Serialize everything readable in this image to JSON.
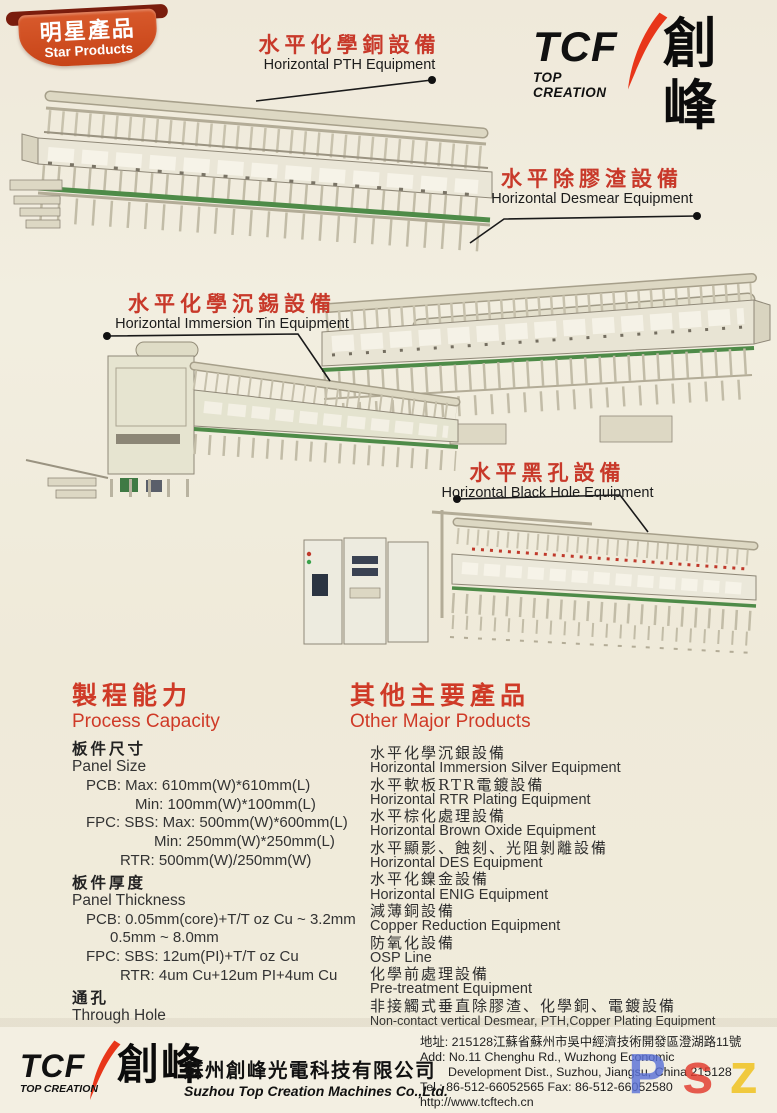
{
  "badge": {
    "title_zh": "明星產品",
    "title_en": "Star Products"
  },
  "logo": {
    "tcf": "TCF",
    "zh": "創峰",
    "sub": "TOP CREATION"
  },
  "callouts": [
    {
      "zh": "水平化學銅設備",
      "en": "Horizontal PTH Equipment"
    },
    {
      "zh": "水平除膠渣設備",
      "en": "Horizontal Desmear Equipment"
    },
    {
      "zh": "水平化學沉錫設備",
      "en": "Horizontal Immersion Tin Equipment"
    },
    {
      "zh": "水平黑孔設備",
      "en": "Horizontal Black Hole Equipment"
    }
  ],
  "process_capacity": {
    "title_zh": "製程能力",
    "title_en": "Process Capacity",
    "sections": [
      {
        "zh": "板件尺寸",
        "en": "Panel Size",
        "lines": [
          {
            "text": "PCB: Max: 610mm(W)*610mm(L)",
            "indent": 1
          },
          {
            "text": "Min: 100mm(W)*100mm(L)",
            "indent": 4
          },
          {
            "text": "FPC: SBS: Max: 500mm(W)*600mm(L)",
            "indent": 1
          },
          {
            "text": "Min: 250mm(W)*250mm(L)",
            "indent": 5
          },
          {
            "text": "RTR: 500mm(W)/250mm(W)",
            "indent": 3
          }
        ]
      },
      {
        "zh": "板件厚度",
        "en": "Panel Thickness",
        "lines": [
          {
            "text": "PCB: 0.05mm(core)+T/T oz Cu ~ 3.2mm",
            "indent": 1
          },
          {
            "text": "0.5mm ~ 8.0mm",
            "indent": 2
          },
          {
            "text": "FPC: SBS: 12um(PI)+T/T oz Cu",
            "indent": 1
          },
          {
            "text": "RTR: 4um Cu+12um PI+4um Cu",
            "indent": 3
          }
        ]
      },
      {
        "zh": "通孔",
        "en": "Through Hole",
        "lines": [
          {
            "text": "A/R 12:1",
            "indent": 1
          }
        ]
      },
      {
        "zh": "盲孔",
        "en": "Blind Hole",
        "lines": [
          {
            "text": "A/R 1:1",
            "indent": 1
          }
        ]
      }
    ]
  },
  "other_products": {
    "title_zh": "其他主要產品",
    "title_en": "Other Major Products",
    "items": [
      {
        "zh": "水平化學沉銀設備",
        "en": "Horizontal Immersion Silver Equipment"
      },
      {
        "zh": "水平軟板RTR電鍍設備",
        "en": "Horizontal RTR Plating Equipment"
      },
      {
        "zh": "水平棕化處理設備",
        "en": "Horizontal Brown Oxide Equipment"
      },
      {
        "zh": "水平顯影、蝕刻、光阻剝離設備",
        "en": "Horizontal DES Equipment"
      },
      {
        "zh": "水平化鎳金設備",
        "en": "Horizontal ENIG Equipment"
      },
      {
        "zh": "減薄銅設備",
        "en": "Copper Reduction Equipment"
      },
      {
        "zh": "防氧化設備",
        "en": "OSP Line"
      },
      {
        "zh": "化學前處理設備",
        "en": "Pre-treatment Equipment"
      },
      {
        "zh": "非接觸式垂直除膠渣、化學銅、電鍍設備",
        "en": "Non-contact vertical Desmear, PTH,Copper Plating Equipment"
      }
    ]
  },
  "footer": {
    "company_zh": "蘇州創峰光電科技有限公司",
    "company_en": "Suzhou Top Creation Machines Co.,Ltd.",
    "address_zh": "地址: 215128江蘇省蘇州市吳中經濟技術開發區澄湖路11號",
    "address_en1": "Add: No.11 Chenghu Rd., Wuzhong Economic",
    "address_en2": "Development Dist., Suzhou, Jiangsu, China 215128",
    "tel_fax": "Tel : 86-512-66052565   Fax: 86-512-66052580",
    "website": "http://www.tcftech.cn"
  },
  "watermark": {
    "letters": [
      {
        "ch": "P",
        "color": "#5b72d8"
      },
      {
        "ch": "s",
        "color": "#e23a2d"
      },
      {
        "ch": "z",
        "color": "#f0c11a"
      },
      {
        "ch": "n",
        "color": "#3aa24b"
      },
      {
        "ch": "h",
        "color": "#f59d1c"
      }
    ]
  },
  "colors": {
    "paper": "#f0ebdd",
    "accent_red": "#cf3a27",
    "badge_orange": "#c74317",
    "badge_maroon": "#7a1d0d",
    "logo_red": "#e8361a",
    "machine_body": "#eae6d7",
    "conveyor_green": "#4e8b48"
  }
}
